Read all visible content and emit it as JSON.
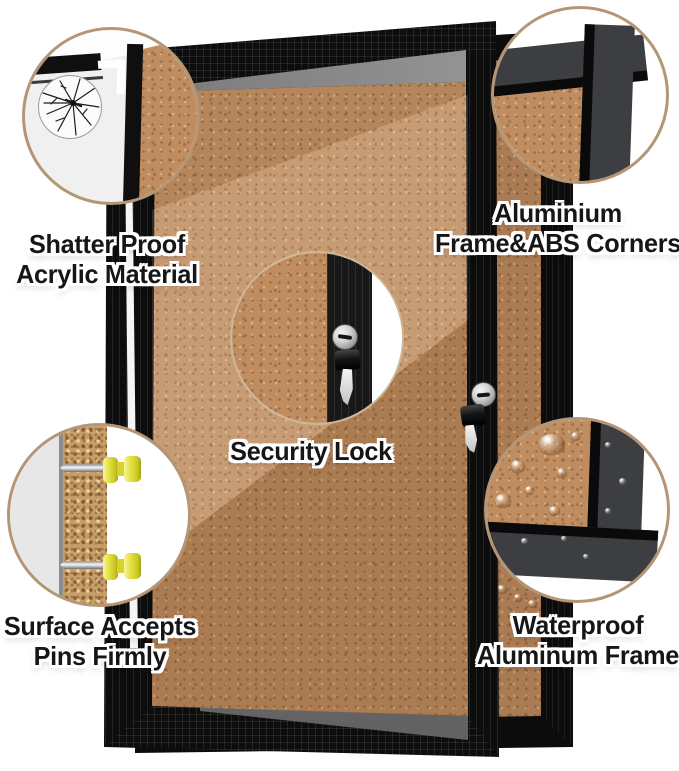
{
  "callout_labels": {
    "shatterproof": {
      "line1": "Shatter Proof",
      "line2": "Acrylic Material"
    },
    "frame_corners": {
      "line1": "Aluminium",
      "line2": "Frame&ABS Corners"
    },
    "security_lock": {
      "line1": "Security Lock"
    },
    "pins": {
      "line1": "Surface Accepts",
      "line2": "Pins Firmly"
    },
    "waterproof": {
      "line1": "Waterproof",
      "line2": "Aluminum Frame"
    }
  },
  "colors": {
    "background": "#ffffff",
    "cork": "#bf8d60",
    "frame_black": "#0d0d0d",
    "frame_gray_profile": "#3c3e41",
    "callout_ring": "#b49677",
    "acrylic_gray": "#f0f0f0",
    "pushpin_yellow": "#e3e040",
    "lock_silver": "#c9c9c9",
    "label_text": "#161616",
    "label_outline": "#ffffff"
  },
  "icons": {
    "crack": "crack-icon",
    "lock": "lock-icon",
    "key": "key-icon",
    "pushpin": "pushpin-icon",
    "water_drop": "water-drop-icon"
  }
}
